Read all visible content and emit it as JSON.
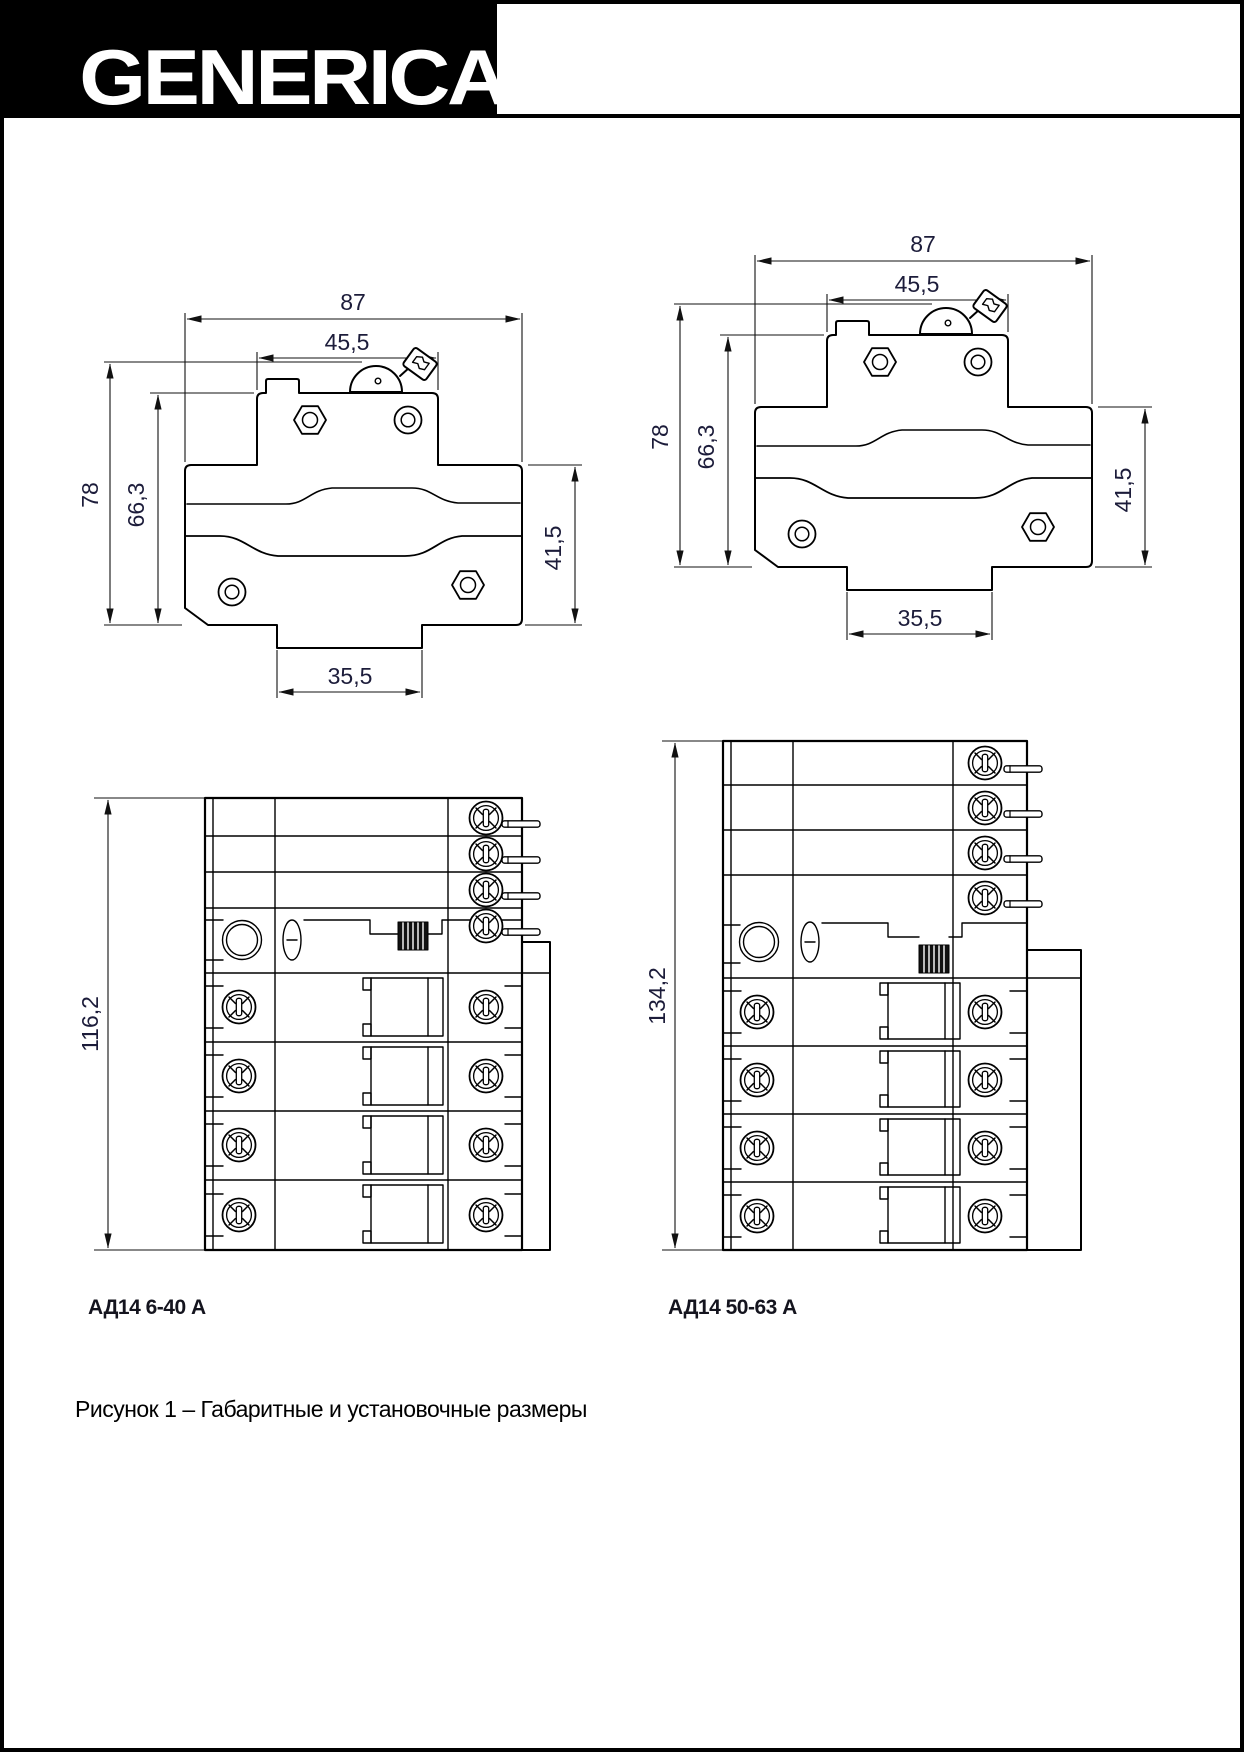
{
  "brand": "GENERICA",
  "figure_caption": "Рисунок 1 – Габаритные и установочные размеры",
  "colors": {
    "dim_text": "#1c1c3a",
    "line": "#000000",
    "logo_bg": "#000000",
    "logo_fg": "#ffffff"
  },
  "side_views": {
    "left": {
      "dims": {
        "total_width": "87",
        "top_width": "45,5",
        "total_height": "78",
        "body_height": "66,3",
        "right_height": "41,5",
        "foot_width": "35,5"
      }
    },
    "right": {
      "dims": {
        "total_width": "87",
        "top_width": "45,5",
        "total_height": "78",
        "body_height": "66,3",
        "right_height": "41,5",
        "foot_width": "35,5"
      }
    }
  },
  "front_views": {
    "left": {
      "caption": "АД14 6-40 А",
      "height": "116,2"
    },
    "right": {
      "caption": "АД14 50-63 А",
      "height": "134,2"
    }
  }
}
